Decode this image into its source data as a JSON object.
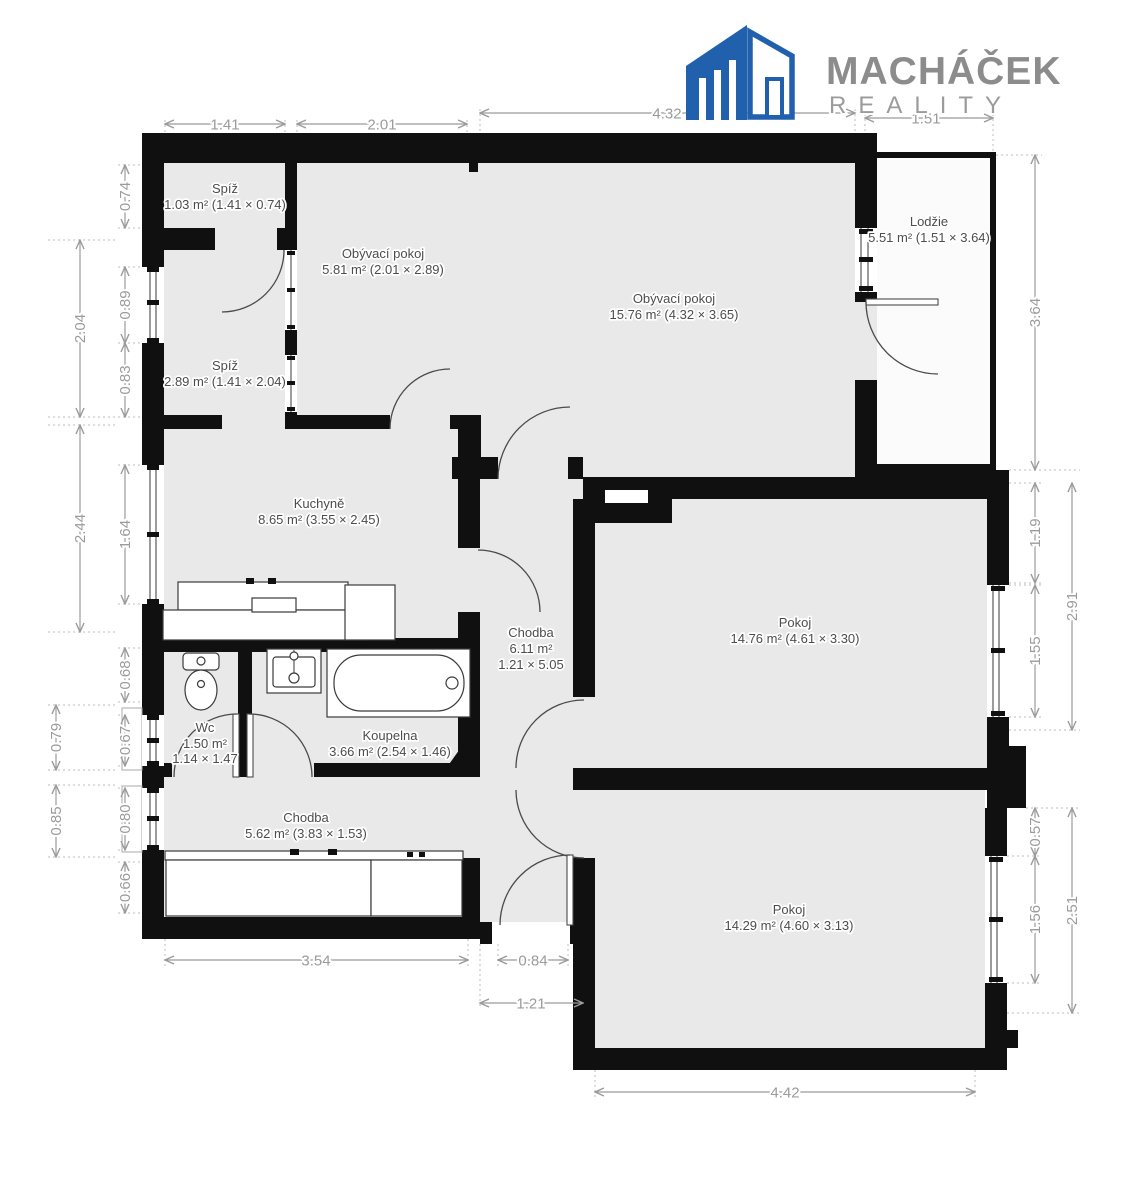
{
  "logo": {
    "brand": "MACHÁČEK",
    "subtitle": "REALITY",
    "brand_color": "#8c8c8c",
    "icon": "building-icon",
    "icon_color": "#2160ad"
  },
  "colors": {
    "wall": "#101010",
    "floor": "#e9e9e9",
    "dimension": "#9b9b9b",
    "label": "#4d4d4d",
    "background": "#ffffff"
  },
  "rooms": [
    {
      "id": "spiz-1",
      "name": "Spíž",
      "area": "1.03 m² (1.41 × 0.74)"
    },
    {
      "id": "obyvaci-pokoj-maly",
      "name": "Obývací pokoj",
      "area": "5.81 m² (2.01 × 2.89)"
    },
    {
      "id": "obyvaci-pokoj",
      "name": "Obývací pokoj",
      "area": "15.76 m² (4.32 × 3.65)"
    },
    {
      "id": "lodzie",
      "name": "Lodžie",
      "area": "5.51 m² (1.51 × 3.64)"
    },
    {
      "id": "spiz-2",
      "name": "Spíž",
      "area": "2.89 m² (1.41 × 2.04)"
    },
    {
      "id": "kuchyne",
      "name": "Kuchyně",
      "area": "8.65 m² (3.55 × 2.45)"
    },
    {
      "id": "chodba-1",
      "name": "Chodba",
      "area": "6.11 m²",
      "dims": "1.21 × 5.05"
    },
    {
      "id": "pokoj-1",
      "name": "Pokoj",
      "area": "14.76 m² (4.61 × 3.30)"
    },
    {
      "id": "wc",
      "name": "Wc",
      "area": "1.50 m²",
      "dims": "1.14 × 1.47"
    },
    {
      "id": "koupelna",
      "name": "Koupelna",
      "area": "3.66 m² (2.54 × 1.46)"
    },
    {
      "id": "chodba-2",
      "name": "Chodba",
      "area": "5.62 m² (3.83 × 1.53)"
    },
    {
      "id": "pokoj-2",
      "name": "Pokoj",
      "area": "14.29 m² (4.60 × 3.13)"
    }
  ],
  "dimensions": {
    "top": [
      "1.41",
      "2.01",
      "4.32",
      "1.51"
    ],
    "left_inner": [
      "0.74",
      "0.89",
      "0.83",
      "1.64",
      "0.68",
      "0.67",
      "0.80",
      "0.66"
    ],
    "left_outer": [
      "2.04",
      "2.44",
      "0.79",
      "0.85"
    ],
    "right_inner": [
      "3.64",
      "1.19",
      "1.55",
      "0.57",
      "1.56"
    ],
    "right_outer": [
      "2.91",
      "2.51"
    ],
    "bottom": [
      "3.54",
      "0.84",
      "1.21",
      "4.42"
    ]
  },
  "fixtures": [
    "toilet",
    "sink",
    "bathtub",
    "kitchen-counter",
    "stove",
    "wardrobe"
  ]
}
